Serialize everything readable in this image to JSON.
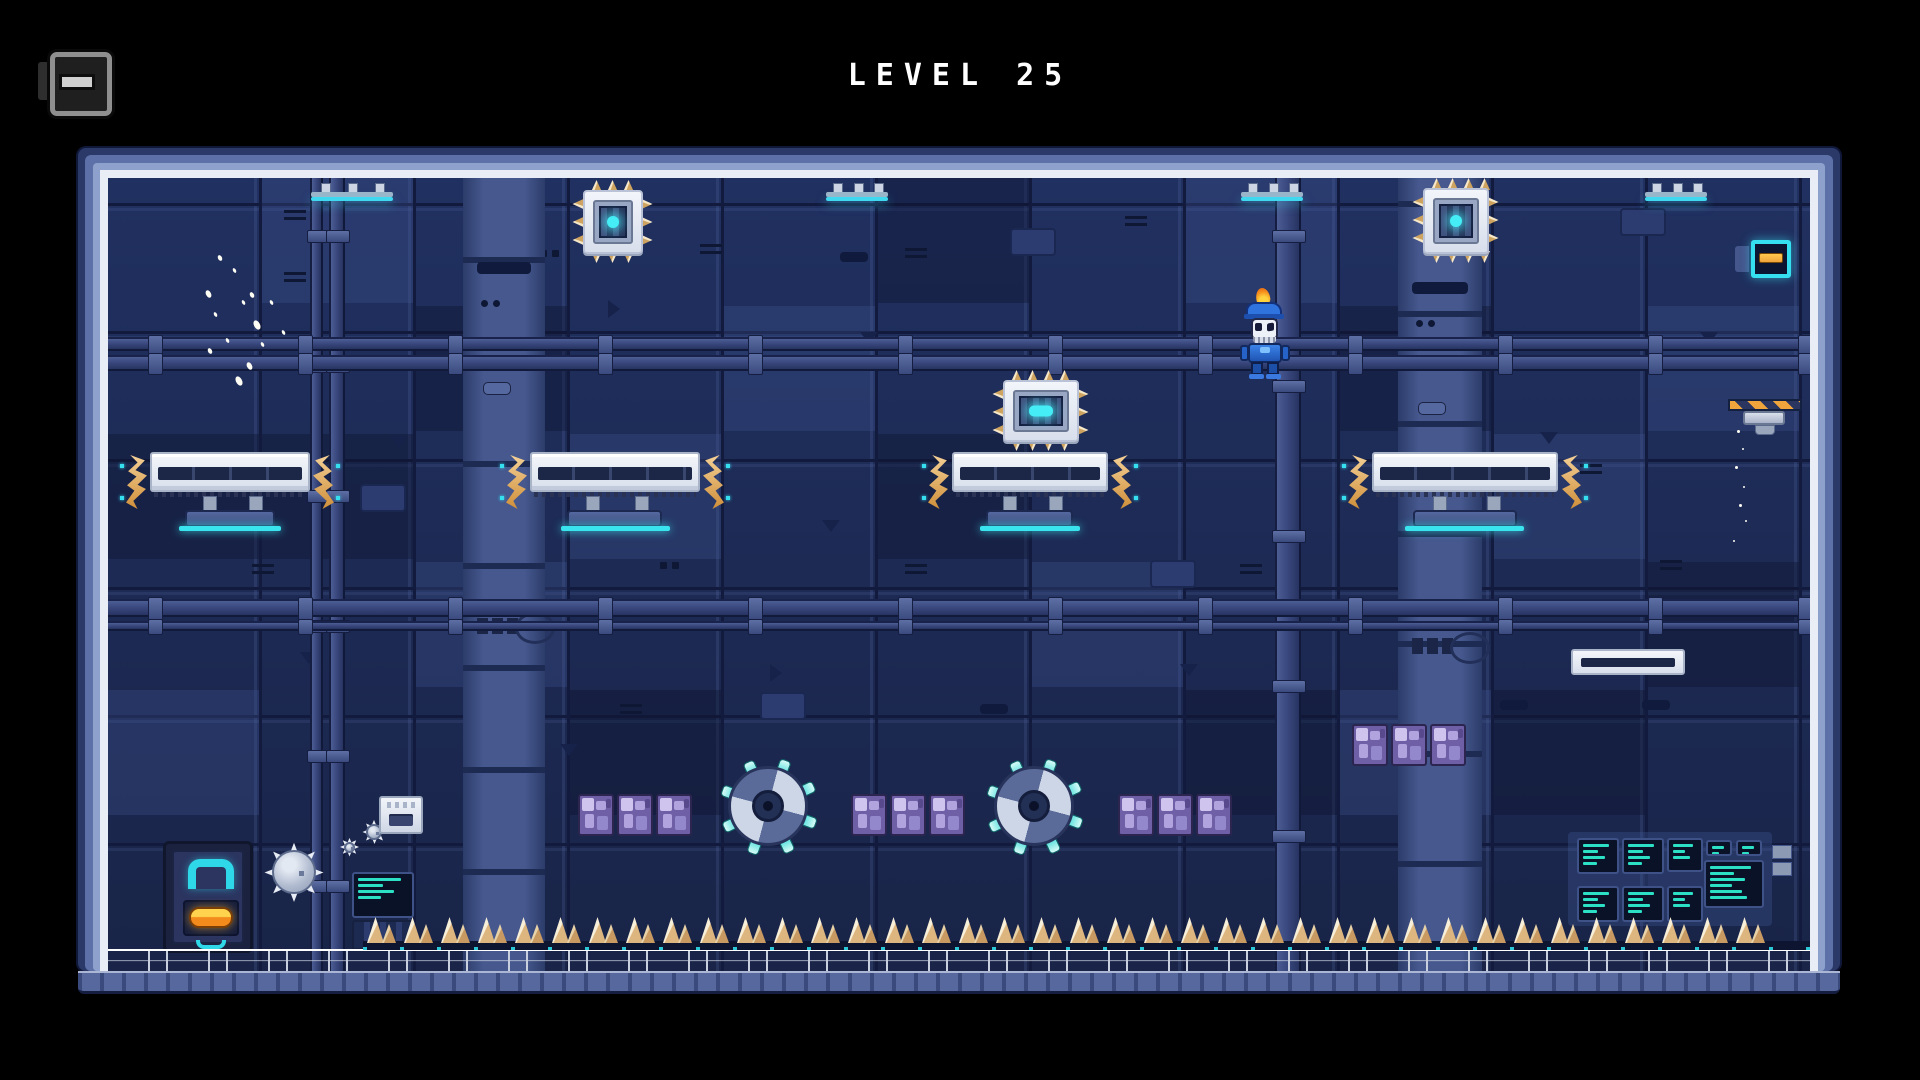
{
  "hud": {
    "title": "LEVEL 25",
    "level_number": 25,
    "menu_button": {
      "icon": "cartridge-menu-icon"
    }
  },
  "palette": {
    "background": "#000000",
    "frame_outer": "#2b3968",
    "frame_mid": "#5d70a8",
    "frame_light": "#8ea0cc",
    "frame_lining": "#e9edf5",
    "wall_base": "#1d2a55",
    "wall_seam": "#121b3e",
    "pipe": "#36447a",
    "column": "#46588e",
    "platform_white": "#eef1f7",
    "accent_cyan": "#3ae4ee",
    "accent_orange": "#eda449",
    "spike_tan": "#e7c897",
    "crystal_purple": "#8d7ec6",
    "terminal_teal": "#2be0c4",
    "door_orange": "#f28a1c",
    "door_yellow": "#ffd34d",
    "player_blue": "#2a6ad4"
  },
  "arena": {
    "origin": {
      "x": 108,
      "y": 178,
      "width": 1702,
      "height": 793
    },
    "lamps": [
      {
        "x": 311,
        "y": 183,
        "w": 82
      },
      {
        "x": 826,
        "y": 183,
        "w": 62
      },
      {
        "x": 1241,
        "y": 183,
        "w": 62
      },
      {
        "x": 1645,
        "y": 183,
        "w": 62
      }
    ],
    "vertical_pipes": [
      {
        "x": 310,
        "w": 13,
        "style": "thin"
      },
      {
        "x": 329,
        "w": 16,
        "style": "thin"
      },
      {
        "x": 1275,
        "w": 26,
        "style": "main"
      }
    ],
    "columns": [
      {
        "x": 463,
        "w": 82
      },
      {
        "x": 1398,
        "w": 84
      }
    ],
    "horizontal_pipes": [
      {
        "y": 337,
        "h": 14
      },
      {
        "y": 355,
        "h": 16
      },
      {
        "y": 599,
        "h": 18
      },
      {
        "y": 621,
        "h": 10
      }
    ],
    "spiked_chips": [
      {
        "x": 583,
        "y": 190,
        "w": 60,
        "h": 64,
        "core": "dot"
      },
      {
        "x": 1423,
        "y": 188,
        "w": 66,
        "h": 66,
        "core": "dot"
      },
      {
        "x": 1003,
        "y": 380,
        "w": 76,
        "h": 62,
        "core": "bar"
      }
    ],
    "platforms": [
      {
        "x": 150,
        "y": 452,
        "w": 160
      },
      {
        "x": 530,
        "y": 452,
        "w": 170
      },
      {
        "x": 952,
        "y": 452,
        "w": 156
      },
      {
        "x": 1372,
        "y": 452,
        "w": 186
      }
    ],
    "shelf": {
      "x": 1571,
      "y": 649,
      "w": 114,
      "h": 26
    },
    "saws": [
      {
        "cx": 768,
        "cy": 806,
        "r": 40
      },
      {
        "cx": 1034,
        "cy": 806,
        "r": 40
      }
    ],
    "crystal_block": {
      "w": 36,
      "h": 42,
      "gap": 3
    },
    "crystal_groups": [
      {
        "x": 578,
        "y": 794,
        "count": 3
      },
      {
        "x": 851,
        "y": 794,
        "count": 3
      },
      {
        "x": 1118,
        "y": 794,
        "count": 3
      },
      {
        "x": 1352,
        "y": 724,
        "count": 3
      }
    ],
    "door": {
      "x": 163,
      "y": 841,
      "w": 90,
      "h": 112
    },
    "mines": [
      {
        "x": 270,
        "y": 848,
        "d": 48
      },
      {
        "x": 364,
        "y": 822,
        "d": 20
      },
      {
        "x": 342,
        "y": 840,
        "d": 15
      }
    ],
    "dispenser": {
      "x": 379,
      "y": 796,
      "w": 44,
      "h": 38
    },
    "terminal_small": {
      "x": 352,
      "y": 872,
      "w": 62,
      "h": 46,
      "lines": 4
    },
    "machine_box": {
      "x": 352,
      "y": 920,
      "w": 62,
      "h": 30
    },
    "terminal_bank": {
      "backing": {
        "x": 1568,
        "y": 832,
        "w": 204,
        "h": 94
      },
      "screens": [
        {
          "x": 1577,
          "y": 838,
          "w": 42,
          "h": 36,
          "lines": 4
        },
        {
          "x": 1622,
          "y": 838,
          "w": 42,
          "h": 36,
          "lines": 4
        },
        {
          "x": 1667,
          "y": 838,
          "w": 36,
          "h": 34,
          "lines": 3
        },
        {
          "x": 1706,
          "y": 840,
          "w": 26,
          "h": 16,
          "lines": 2
        },
        {
          "x": 1736,
          "y": 840,
          "w": 26,
          "h": 16,
          "lines": 2
        },
        {
          "x": 1704,
          "y": 860,
          "w": 60,
          "h": 48,
          "lines": 6
        },
        {
          "x": 1577,
          "y": 886,
          "w": 42,
          "h": 36,
          "lines": 4
        },
        {
          "x": 1622,
          "y": 886,
          "w": 42,
          "h": 36,
          "lines": 4
        },
        {
          "x": 1667,
          "y": 886,
          "w": 36,
          "h": 36,
          "lines": 3
        }
      ],
      "side_tabs": [
        {
          "x": 1772,
          "y": 845,
          "w": 18,
          "h": 12
        },
        {
          "x": 1772,
          "y": 862,
          "w": 18,
          "h": 12
        }
      ]
    },
    "hazard_dropper": {
      "bar": {
        "x": 1728,
        "y": 399,
        "w": 74,
        "h": 12
      },
      "device": {
        "x": 1743,
        "y": 411,
        "w": 42,
        "h": 14
      },
      "nub": {
        "x": 1755,
        "y": 425,
        "w": 18,
        "h": 8
      }
    },
    "outlet": {
      "x": 1751,
      "y": 240,
      "w": 40,
      "h": 38,
      "bracket": {
        "x": 1735,
        "y": 246,
        "w": 14,
        "h": 26
      }
    },
    "spike_floor": {
      "x": 367,
      "end": 1806,
      "y": 917,
      "cluster_w": 37,
      "spike_h": 26
    },
    "floor": {
      "y": 949,
      "h": 22
    },
    "player": {
      "x": 1240,
      "y": 290,
      "w": 50,
      "h": 90,
      "state": "climbing-pipe"
    },
    "decor": {
      "tile": {
        "w": 154,
        "h": 128
      },
      "panel_overlays": {
        "light": [
          [
            1,
            0
          ],
          [
            4,
            1
          ],
          [
            7,
            0
          ],
          [
            2,
            3
          ],
          [
            6,
            3
          ],
          [
            9,
            2
          ],
          [
            0,
            4
          ],
          [
            10,
            1
          ],
          [
            3,
            2
          ],
          [
            8,
            4
          ]
        ],
        "dark": [
          [
            2,
            1
          ],
          [
            5,
            2
          ],
          [
            8,
            1
          ],
          [
            3,
            4
          ],
          [
            10,
            3
          ],
          [
            1,
            2
          ],
          [
            7,
            4
          ],
          [
            5,
            0
          ],
          [
            0,
            2
          ],
          [
            9,
            4
          ]
        ]
      },
      "details": [
        {
          "t": "vent",
          "x": 284,
          "y": 206
        },
        {
          "t": "vent",
          "x": 284,
          "y": 268
        },
        {
          "t": "vent",
          "x": 193,
          "y": 344
        },
        {
          "t": "vent",
          "x": 700,
          "y": 240
        },
        {
          "t": "vent",
          "x": 905,
          "y": 244
        },
        {
          "t": "vent",
          "x": 1125,
          "y": 212
        },
        {
          "t": "vent",
          "x": 1340,
          "y": 352
        },
        {
          "t": "vent",
          "x": 252,
          "y": 560
        },
        {
          "t": "vent",
          "x": 905,
          "y": 560
        },
        {
          "t": "vent",
          "x": 1240,
          "y": 560
        },
        {
          "t": "vent",
          "x": 1660,
          "y": 556
        },
        {
          "t": "vent",
          "x": 620,
          "y": 700
        },
        {
          "t": "vent",
          "x": 1580,
          "y": 460
        },
        {
          "t": "tri-down",
          "x": 390,
          "y": 436
        },
        {
          "t": "tri-down",
          "x": 822,
          "y": 520
        },
        {
          "t": "tri-down",
          "x": 1180,
          "y": 664
        },
        {
          "t": "tri-down",
          "x": 560,
          "y": 744
        },
        {
          "t": "tri-down",
          "x": 1540,
          "y": 432
        },
        {
          "t": "tri-down",
          "x": 300,
          "y": 652
        },
        {
          "t": "tri-down",
          "x": 1700,
          "y": 332
        },
        {
          "t": "tri-down",
          "x": 860,
          "y": 332
        },
        {
          "t": "tri-right",
          "x": 608,
          "y": 300
        },
        {
          "t": "tri-right",
          "x": 1375,
          "y": 470
        },
        {
          "t": "tri-right",
          "x": 770,
          "y": 664
        },
        {
          "t": "slot",
          "x": 840,
          "y": 252
        },
        {
          "t": "slot",
          "x": 1500,
          "y": 700
        },
        {
          "t": "slot",
          "x": 430,
          "y": 600
        },
        {
          "t": "slot",
          "x": 980,
          "y": 704
        },
        {
          "t": "slot",
          "x": 1642,
          "y": 700
        },
        {
          "t": "plate",
          "x": 1010,
          "y": 228
        },
        {
          "t": "plate",
          "x": 1620,
          "y": 208
        },
        {
          "t": "plate",
          "x": 760,
          "y": 692
        },
        {
          "t": "plate",
          "x": 360,
          "y": 484
        },
        {
          "t": "plate",
          "x": 1150,
          "y": 560
        },
        {
          "t": "dots",
          "x": 660,
          "y": 562
        },
        {
          "t": "dots",
          "x": 540,
          "y": 250
        },
        {
          "t": "dots",
          "x": 1440,
          "y": 700
        }
      ],
      "sparkles": [
        {
          "x": 218,
          "y": 255,
          "s": 4
        },
        {
          "x": 233,
          "y": 268,
          "s": 3
        },
        {
          "x": 206,
          "y": 290,
          "s": 5
        },
        {
          "x": 242,
          "y": 300,
          "s": 3
        },
        {
          "x": 254,
          "y": 320,
          "s": 6
        },
        {
          "x": 226,
          "y": 338,
          "s": 3
        },
        {
          "x": 208,
          "y": 348,
          "s": 4
        },
        {
          "x": 247,
          "y": 362,
          "s": 5
        },
        {
          "x": 261,
          "y": 342,
          "s": 3
        },
        {
          "x": 236,
          "y": 376,
          "s": 6
        },
        {
          "x": 214,
          "y": 312,
          "s": 3
        },
        {
          "x": 250,
          "y": 292,
          "s": 4
        },
        {
          "x": 282,
          "y": 330,
          "s": 3
        },
        {
          "x": 270,
          "y": 300,
          "s": 3
        }
      ],
      "drips": [
        {
          "x": 1737,
          "y": 430,
          "s": 3
        },
        {
          "x": 1742,
          "y": 448,
          "s": 2
        },
        {
          "x": 1735,
          "y": 466,
          "s": 3
        },
        {
          "x": 1743,
          "y": 486,
          "s": 2
        },
        {
          "x": 1739,
          "y": 504,
          "s": 3
        },
        {
          "x": 1745,
          "y": 520,
          "s": 2
        },
        {
          "x": 1733,
          "y": 540,
          "s": 2
        }
      ]
    }
  }
}
